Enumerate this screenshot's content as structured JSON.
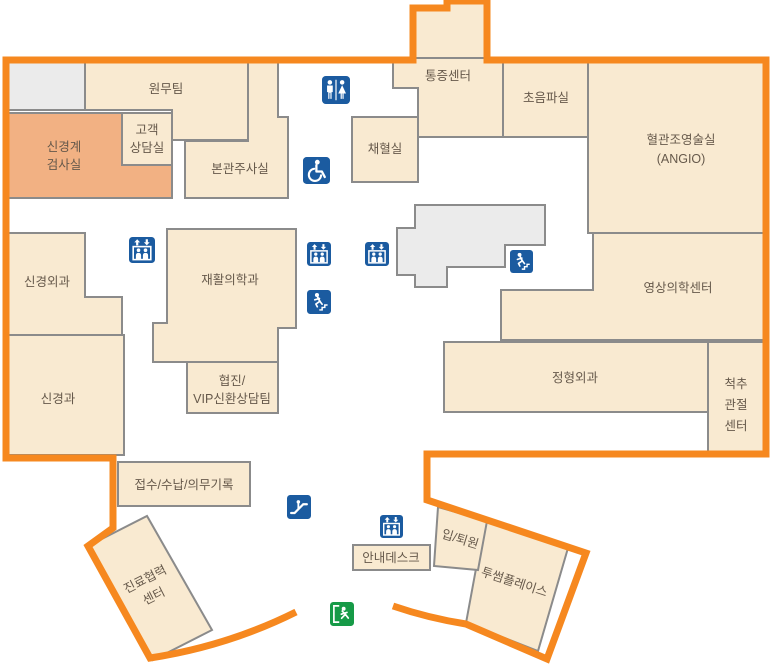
{
  "map": {
    "type": "hospital-floor-plan",
    "colors": {
      "outline": "#F6881F",
      "room_fill": "#F9EAD1",
      "room_stroke": "#8B8B8B",
      "highlight_fill": "#F2B183",
      "gray_fill": "#EBEBEB",
      "label_text": "#66594B",
      "icon_blue": "#1B5BA0",
      "icon_green": "#169A47"
    },
    "rooms": {
      "administration_office": {
        "label": "원무팀"
      },
      "neuro_exam_room": {
        "line1": "신경계",
        "line2": "검사실"
      },
      "customer_consult_room": {
        "line1": "고객",
        "line2": "상담실"
      },
      "injection_room": {
        "label": "본관주사실"
      },
      "blood_collection_room": {
        "label": "채혈실"
      },
      "pain_center": {
        "label": "통증센터"
      },
      "ultrasound_room": {
        "label": "초음파실"
      },
      "angio_room": {
        "line1": "혈관조영술실",
        "line2": "(ANGIO)"
      },
      "imaging_center": {
        "label": "영상의학센터"
      },
      "orthopedics": {
        "label": "정형외과"
      },
      "spine_joint_center": {
        "line1": "척추",
        "line2": "관절",
        "line3": "센터"
      },
      "neurosurgery": {
        "label": "신경외과"
      },
      "neurology": {
        "label": "신경과"
      },
      "rehabilitation_medicine": {
        "label": "재활의학과"
      },
      "vip_consult_team": {
        "line1": "협진/",
        "line2": "VIP신환상담팀"
      },
      "reception_records": {
        "label": "접수/수납/의무기록"
      },
      "information_desk": {
        "label": "안내데스크"
      },
      "admission_discharge": {
        "label": "입/퇴원"
      },
      "twosome_place": {
        "label": "투썸플레이스"
      },
      "care_coordination_center": {
        "line1": "진료협력",
        "line2": "센터"
      }
    },
    "icons": {
      "restroom": "restroom-icon",
      "wheelchair": "wheelchair-accessible-icon",
      "elevator": "elevator-icon",
      "stairs": "emergency-stairs-icon",
      "escalator": "escalator-icon",
      "exit": "emergency-exit-icon"
    }
  }
}
